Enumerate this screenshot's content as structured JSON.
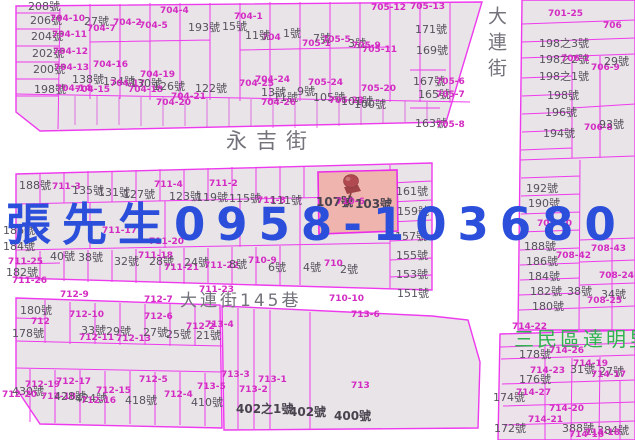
{
  "map": {
    "title": "cadastral-parcel-map",
    "watermark": {
      "text": "張先生0958-103680",
      "color": "#2b4fdb"
    },
    "highlight": {
      "addresses": "107號 103號",
      "fill": "#f0b4ae"
    },
    "colors": {
      "parcel_line": "#ee3aee",
      "parcel_fill": "#e9e4e8",
      "parcel_number_text": "#d32cc2",
      "address_text": "#56515d",
      "street_text": "#73737b",
      "district_text": "#2fb34f",
      "pin": "#b04a50"
    },
    "streets": {
      "horizontal": "永吉街",
      "vertical": "大連街",
      "lane": "大連街145巷"
    },
    "district": "三民區達明里",
    "labels": [
      {
        "t": "208號",
        "x": 28,
        "y": 1,
        "c": "a"
      },
      {
        "t": "206號",
        "x": 30,
        "y": 15,
        "c": "a"
      },
      {
        "t": "704-10",
        "x": 50,
        "y": 15,
        "c": "p"
      },
      {
        "t": "204號",
        "x": 31,
        "y": 31,
        "c": "a"
      },
      {
        "t": "704-11",
        "x": 52,
        "y": 31,
        "c": "p"
      },
      {
        "t": "202號",
        "x": 32,
        "y": 48,
        "c": "a"
      },
      {
        "t": "704-12",
        "x": 53,
        "y": 48,
        "c": "p"
      },
      {
        "t": "200號",
        "x": 33,
        "y": 64,
        "c": "a"
      },
      {
        "t": "704-13",
        "x": 54,
        "y": 64,
        "c": "p"
      },
      {
        "t": "198號",
        "x": 34,
        "y": 84,
        "c": "a"
      },
      {
        "t": "704-14",
        "x": 56,
        "y": 85,
        "c": "p"
      },
      {
        "t": "27號",
        "x": 84,
        "y": 16,
        "c": "a"
      },
      {
        "t": "704-7",
        "x": 87,
        "y": 25,
        "c": "p"
      },
      {
        "t": "704-4",
        "x": 160,
        "y": 7,
        "c": "p"
      },
      {
        "t": "704-2",
        "x": 113,
        "y": 19,
        "c": "p"
      },
      {
        "t": "704-5",
        "x": 139,
        "y": 22,
        "c": "p"
      },
      {
        "t": "193號",
        "x": 188,
        "y": 22,
        "c": "a"
      },
      {
        "t": "704-16",
        "x": 93,
        "y": 61,
        "c": "p"
      },
      {
        "t": "138號",
        "x": 72,
        "y": 74,
        "c": "a"
      },
      {
        "t": "704-15",
        "x": 75,
        "y": 86,
        "c": "p"
      },
      {
        "t": "134號",
        "x": 103,
        "y": 76,
        "c": "a"
      },
      {
        "t": "704-17",
        "x": 110,
        "y": 80,
        "c": "p"
      },
      {
        "t": "130號",
        "x": 130,
        "y": 78,
        "c": "a"
      },
      {
        "t": "704-18",
        "x": 128,
        "y": 86,
        "c": "p"
      },
      {
        "t": "704-19",
        "x": 140,
        "y": 71,
        "c": "p"
      },
      {
        "t": "126號",
        "x": 153,
        "y": 81,
        "c": "a"
      },
      {
        "t": "704-21",
        "x": 171,
        "y": 93,
        "c": "p"
      },
      {
        "t": "704-20",
        "x": 156,
        "y": 99,
        "c": "p"
      },
      {
        "t": "122號",
        "x": 195,
        "y": 83,
        "c": "a"
      },
      {
        "t": "704-1",
        "x": 234,
        "y": 13,
        "c": "p"
      },
      {
        "t": "15號",
        "x": 222,
        "y": 21,
        "c": "a"
      },
      {
        "t": "704",
        "x": 262,
        "y": 34,
        "c": "p"
      },
      {
        "t": "11號",
        "x": 245,
        "y": 30,
        "c": "a"
      },
      {
        "t": "1號",
        "x": 283,
        "y": 28,
        "c": "a"
      },
      {
        "t": "705-1",
        "x": 302,
        "y": 40,
        "c": "p"
      },
      {
        "t": "7號",
        "x": 313,
        "y": 33,
        "c": "a"
      },
      {
        "t": "705-5",
        "x": 322,
        "y": 36,
        "c": "p"
      },
      {
        "t": "3號",
        "x": 348,
        "y": 38,
        "c": "a"
      },
      {
        "t": "705-9",
        "x": 352,
        "y": 42,
        "c": "p"
      },
      {
        "t": "705-11",
        "x": 362,
        "y": 46,
        "c": "p"
      },
      {
        "t": "705-12",
        "x": 371,
        "y": 4,
        "c": "p"
      },
      {
        "t": "705-13",
        "x": 410,
        "y": 3,
        "c": "p"
      },
      {
        "t": "171號",
        "x": 415,
        "y": 24,
        "c": "a"
      },
      {
        "t": "169號",
        "x": 416,
        "y": 45,
        "c": "a"
      },
      {
        "t": "167號",
        "x": 413,
        "y": 76,
        "c": "a"
      },
      {
        "t": "705-6",
        "x": 436,
        "y": 78,
        "c": "p"
      },
      {
        "t": "165號",
        "x": 418,
        "y": 89,
        "c": "a"
      },
      {
        "t": "705-7",
        "x": 436,
        "y": 91,
        "c": "p"
      },
      {
        "t": "163號",
        "x": 415,
        "y": 118,
        "c": "a"
      },
      {
        "t": "705-8",
        "x": 436,
        "y": 121,
        "c": "p"
      },
      {
        "t": "704-25",
        "x": 239,
        "y": 80,
        "c": "p"
      },
      {
        "t": "704-24",
        "x": 255,
        "y": 76,
        "c": "p"
      },
      {
        "t": "13號",
        "x": 261,
        "y": 87,
        "c": "a"
      },
      {
        "t": "11號",
        "x": 273,
        "y": 92,
        "c": "a"
      },
      {
        "t": "704-26",
        "x": 261,
        "y": 99,
        "c": "p"
      },
      {
        "t": "9號",
        "x": 297,
        "y": 86,
        "c": "a"
      },
      {
        "t": "705-24",
        "x": 308,
        "y": 79,
        "c": "p"
      },
      {
        "t": "105號",
        "x": 313,
        "y": 92,
        "c": "a"
      },
      {
        "t": "705-23",
        "x": 329,
        "y": 97,
        "c": "p"
      },
      {
        "t": "101號",
        "x": 341,
        "y": 96,
        "c": "a"
      },
      {
        "t": "705-20",
        "x": 361,
        "y": 85,
        "c": "p"
      },
      {
        "t": "100號",
        "x": 354,
        "y": 99,
        "c": "a"
      },
      {
        "t": "701-25",
        "x": 548,
        "y": 10,
        "c": "p"
      },
      {
        "t": "706",
        "x": 603,
        "y": 22,
        "c": "p"
      },
      {
        "t": "198之3號",
        "x": 539,
        "y": 38,
        "c": "a"
      },
      {
        "t": "198之2號",
        "x": 539,
        "y": 54,
        "c": "a"
      },
      {
        "t": "706-2",
        "x": 561,
        "y": 55,
        "c": "p"
      },
      {
        "t": "198之1號",
        "x": 539,
        "y": 71,
        "c": "a"
      },
      {
        "t": "706-9",
        "x": 591,
        "y": 64,
        "c": "p"
      },
      {
        "t": "29號",
        "x": 604,
        "y": 56,
        "c": "a"
      },
      {
        "t": "198號",
        "x": 547,
        "y": 90,
        "c": "a"
      },
      {
        "t": "196號",
        "x": 545,
        "y": 107,
        "c": "a"
      },
      {
        "t": "194號",
        "x": 543,
        "y": 128,
        "c": "a"
      },
      {
        "t": "706-8",
        "x": 584,
        "y": 124,
        "c": "p"
      },
      {
        "t": "93號",
        "x": 599,
        "y": 119,
        "c": "a"
      },
      {
        "t": "192號",
        "x": 526,
        "y": 183,
        "c": "a"
      },
      {
        "t": "190號",
        "x": 528,
        "y": 198,
        "c": "a"
      },
      {
        "t": "708-40",
        "x": 537,
        "y": 220,
        "c": "p"
      },
      {
        "t": "188號",
        "x": 524,
        "y": 241,
        "c": "a"
      },
      {
        "t": "186號",
        "x": 526,
        "y": 256,
        "c": "a"
      },
      {
        "t": "184號",
        "x": 528,
        "y": 271,
        "c": "a"
      },
      {
        "t": "182號",
        "x": 530,
        "y": 286,
        "c": "a"
      },
      {
        "t": "180號",
        "x": 532,
        "y": 301,
        "c": "a"
      },
      {
        "t": "708-43",
        "x": 591,
        "y": 245,
        "c": "p"
      },
      {
        "t": "708-42",
        "x": 556,
        "y": 252,
        "c": "p"
      },
      {
        "t": "38號",
        "x": 567,
        "y": 286,
        "c": "a"
      },
      {
        "t": "708-24",
        "x": 599,
        "y": 272,
        "c": "p"
      },
      {
        "t": "34號",
        "x": 601,
        "y": 289,
        "c": "a"
      },
      {
        "t": "708-25",
        "x": 587,
        "y": 297,
        "c": "p"
      },
      {
        "t": "188號",
        "x": 19,
        "y": 180,
        "c": "a"
      },
      {
        "t": "711-3",
        "x": 52,
        "y": 183,
        "c": "p"
      },
      {
        "t": "135號",
        "x": 72,
        "y": 185,
        "c": "a"
      },
      {
        "t": "131號",
        "x": 98,
        "y": 187,
        "c": "a"
      },
      {
        "t": "127號",
        "x": 123,
        "y": 189,
        "c": "a"
      },
      {
        "t": "711-4",
        "x": 154,
        "y": 181,
        "c": "p"
      },
      {
        "t": "711-2",
        "x": 209,
        "y": 180,
        "c": "p"
      },
      {
        "t": "123號",
        "x": 169,
        "y": 191,
        "c": "a"
      },
      {
        "t": "119號",
        "x": 196,
        "y": 192,
        "c": "a"
      },
      {
        "t": "115號",
        "x": 229,
        "y": 193,
        "c": "a"
      },
      {
        "t": "711-8",
        "x": 257,
        "y": 197,
        "c": "p"
      },
      {
        "t": "111號",
        "x": 270,
        "y": 195,
        "c": "a"
      },
      {
        "t": "186號",
        "x": 3,
        "y": 225,
        "c": "a"
      },
      {
        "t": "184號",
        "x": 3,
        "y": 241,
        "c": "a"
      },
      {
        "t": "711-17",
        "x": 102,
        "y": 227,
        "c": "p"
      },
      {
        "t": "711-20",
        "x": 149,
        "y": 238,
        "c": "p"
      },
      {
        "t": "711-25",
        "x": 8,
        "y": 258,
        "c": "p"
      },
      {
        "t": "182號",
        "x": 6,
        "y": 267,
        "c": "a"
      },
      {
        "t": "711-26",
        "x": 12,
        "y": 277,
        "c": "p"
      },
      {
        "t": "40號",
        "x": 50,
        "y": 251,
        "c": "a"
      },
      {
        "t": "38號",
        "x": 78,
        "y": 252,
        "c": "a"
      },
      {
        "t": "711-18",
        "x": 138,
        "y": 252,
        "c": "p"
      },
      {
        "t": "32號",
        "x": 114,
        "y": 256,
        "c": "a"
      },
      {
        "t": "28號",
        "x": 149,
        "y": 256,
        "c": "a"
      },
      {
        "t": "711-21",
        "x": 164,
        "y": 264,
        "c": "p"
      },
      {
        "t": "24號",
        "x": 184,
        "y": 257,
        "c": "a"
      },
      {
        "t": "711-22",
        "x": 204,
        "y": 262,
        "c": "p"
      },
      {
        "t": "8號",
        "x": 229,
        "y": 259,
        "c": "a"
      },
      {
        "t": "710-9",
        "x": 248,
        "y": 257,
        "c": "p"
      },
      {
        "t": "6號",
        "x": 268,
        "y": 262,
        "c": "a"
      },
      {
        "t": "107號",
        "x": 316,
        "y": 196,
        "c": "a2"
      },
      {
        "t": "710-6",
        "x": 336,
        "y": 198,
        "c": "p"
      },
      {
        "t": "103號",
        "x": 355,
        "y": 198,
        "c": "a2"
      },
      {
        "t": "161號",
        "x": 396,
        "y": 186,
        "c": "a"
      },
      {
        "t": "159號",
        "x": 397,
        "y": 206,
        "c": "a"
      },
      {
        "t": "157號",
        "x": 395,
        "y": 231,
        "c": "a"
      },
      {
        "t": "155號",
        "x": 396,
        "y": 250,
        "c": "a"
      },
      {
        "t": "153號",
        "x": 396,
        "y": 269,
        "c": "a"
      },
      {
        "t": "151號",
        "x": 397,
        "y": 288,
        "c": "a"
      },
      {
        "t": "4號",
        "x": 303,
        "y": 262,
        "c": "a"
      },
      {
        "t": "710",
        "x": 324,
        "y": 260,
        "c": "p"
      },
      {
        "t": "2號",
        "x": 340,
        "y": 264,
        "c": "a"
      },
      {
        "t": "大連街145巷",
        "x": 180,
        "y": 293,
        "c": "s2"
      },
      {
        "t": "710-10",
        "x": 329,
        "y": 295,
        "c": "p"
      },
      {
        "t": "713-6",
        "x": 351,
        "y": 311,
        "c": "p"
      },
      {
        "t": "712-9",
        "x": 60,
        "y": 291,
        "c": "p"
      },
      {
        "t": "712-7",
        "x": 144,
        "y": 296,
        "c": "p"
      },
      {
        "t": "711-23",
        "x": 199,
        "y": 286,
        "c": "p"
      },
      {
        "t": "713-4",
        "x": 205,
        "y": 321,
        "c": "p"
      },
      {
        "t": "180號",
        "x": 20,
        "y": 305,
        "c": "a"
      },
      {
        "t": "712-10",
        "x": 69,
        "y": 311,
        "c": "p"
      },
      {
        "t": "712",
        "x": 31,
        "y": 318,
        "c": "p"
      },
      {
        "t": "178號",
        "x": 12,
        "y": 328,
        "c": "a"
      },
      {
        "t": "33號",
        "x": 81,
        "y": 325,
        "c": "a"
      },
      {
        "t": "29號",
        "x": 106,
        "y": 326,
        "c": "a"
      },
      {
        "t": "712-11",
        "x": 79,
        "y": 334,
        "c": "p"
      },
      {
        "t": "712-13",
        "x": 116,
        "y": 335,
        "c": "p"
      },
      {
        "t": "27號",
        "x": 143,
        "y": 327,
        "c": "a"
      },
      {
        "t": "25號",
        "x": 166,
        "y": 329,
        "c": "a"
      },
      {
        "t": "712-6",
        "x": 144,
        "y": 313,
        "c": "p"
      },
      {
        "t": "21號",
        "x": 196,
        "y": 330,
        "c": "a"
      },
      {
        "t": "712-2",
        "x": 186,
        "y": 323,
        "c": "p"
      },
      {
        "t": "712-17",
        "x": 56,
        "y": 378,
        "c": "p"
      },
      {
        "t": "712-19",
        "x": 25,
        "y": 381,
        "c": "p"
      },
      {
        "t": "430號",
        "x": 12,
        "y": 386,
        "c": "a"
      },
      {
        "t": "712-20",
        "x": 2,
        "y": 391,
        "c": "p"
      },
      {
        "t": "712-18",
        "x": 41,
        "y": 393,
        "c": "p"
      },
      {
        "t": "428號",
        "x": 54,
        "y": 391,
        "c": "a"
      },
      {
        "t": "424號",
        "x": 75,
        "y": 393,
        "c": "a"
      },
      {
        "t": "712-15",
        "x": 96,
        "y": 387,
        "c": "p"
      },
      {
        "t": "712-16",
        "x": 81,
        "y": 397,
        "c": "p"
      },
      {
        "t": "418號",
        "x": 125,
        "y": 395,
        "c": "a"
      },
      {
        "t": "712-5",
        "x": 139,
        "y": 376,
        "c": "p"
      },
      {
        "t": "712-4",
        "x": 164,
        "y": 391,
        "c": "p"
      },
      {
        "t": "713-5",
        "x": 197,
        "y": 383,
        "c": "p"
      },
      {
        "t": "410號",
        "x": 191,
        "y": 397,
        "c": "a"
      },
      {
        "t": "713-3",
        "x": 221,
        "y": 371,
        "c": "p"
      },
      {
        "t": "713-1",
        "x": 258,
        "y": 376,
        "c": "p"
      },
      {
        "t": "713-2",
        "x": 239,
        "y": 386,
        "c": "p"
      },
      {
        "t": "402之1號",
        "x": 236,
        "y": 403,
        "c": "a2"
      },
      {
        "t": "402號",
        "x": 289,
        "y": 406,
        "c": "a2"
      },
      {
        "t": "400號",
        "x": 334,
        "y": 410,
        "c": "a2"
      },
      {
        "t": "713",
        "x": 351,
        "y": 382,
        "c": "p"
      },
      {
        "t": "714-22",
        "x": 512,
        "y": 323,
        "c": "p"
      },
      {
        "t": "三民區達明里",
        "x": 514,
        "y": 329,
        "c": "g"
      },
      {
        "t": "178號",
        "x": 519,
        "y": 349,
        "c": "a"
      },
      {
        "t": "714-26",
        "x": 549,
        "y": 347,
        "c": "p"
      },
      {
        "t": "714-19",
        "x": 573,
        "y": 360,
        "c": "p"
      },
      {
        "t": "31號",
        "x": 570,
        "y": 364,
        "c": "a"
      },
      {
        "t": "27號",
        "x": 599,
        "y": 366,
        "c": "a"
      },
      {
        "t": "714-17",
        "x": 591,
        "y": 371,
        "c": "p"
      },
      {
        "t": "176號",
        "x": 519,
        "y": 374,
        "c": "a"
      },
      {
        "t": "714-23",
        "x": 530,
        "y": 367,
        "c": "p"
      },
      {
        "t": "174號",
        "x": 493,
        "y": 392,
        "c": "a"
      },
      {
        "t": "714-27",
        "x": 516,
        "y": 389,
        "c": "p"
      },
      {
        "t": "714-20",
        "x": 549,
        "y": 405,
        "c": "p"
      },
      {
        "t": "714-21",
        "x": 528,
        "y": 416,
        "c": "p"
      },
      {
        "t": "172號",
        "x": 494,
        "y": 423,
        "c": "a"
      },
      {
        "t": "388號",
        "x": 562,
        "y": 423,
        "c": "a"
      },
      {
        "t": "384號",
        "x": 597,
        "y": 425,
        "c": "a"
      },
      {
        "t": "714-18",
        "x": 585,
        "y": 429,
        "c": "p"
      },
      {
        "t": "714-16",
        "x": 569,
        "y": 431,
        "c": "p"
      },
      {
        "t": "永吉街",
        "x": 226,
        "y": 131,
        "c": "s"
      },
      {
        "t": "大連街",
        "x": 486,
        "y": 6,
        "c": "sv"
      }
    ]
  }
}
